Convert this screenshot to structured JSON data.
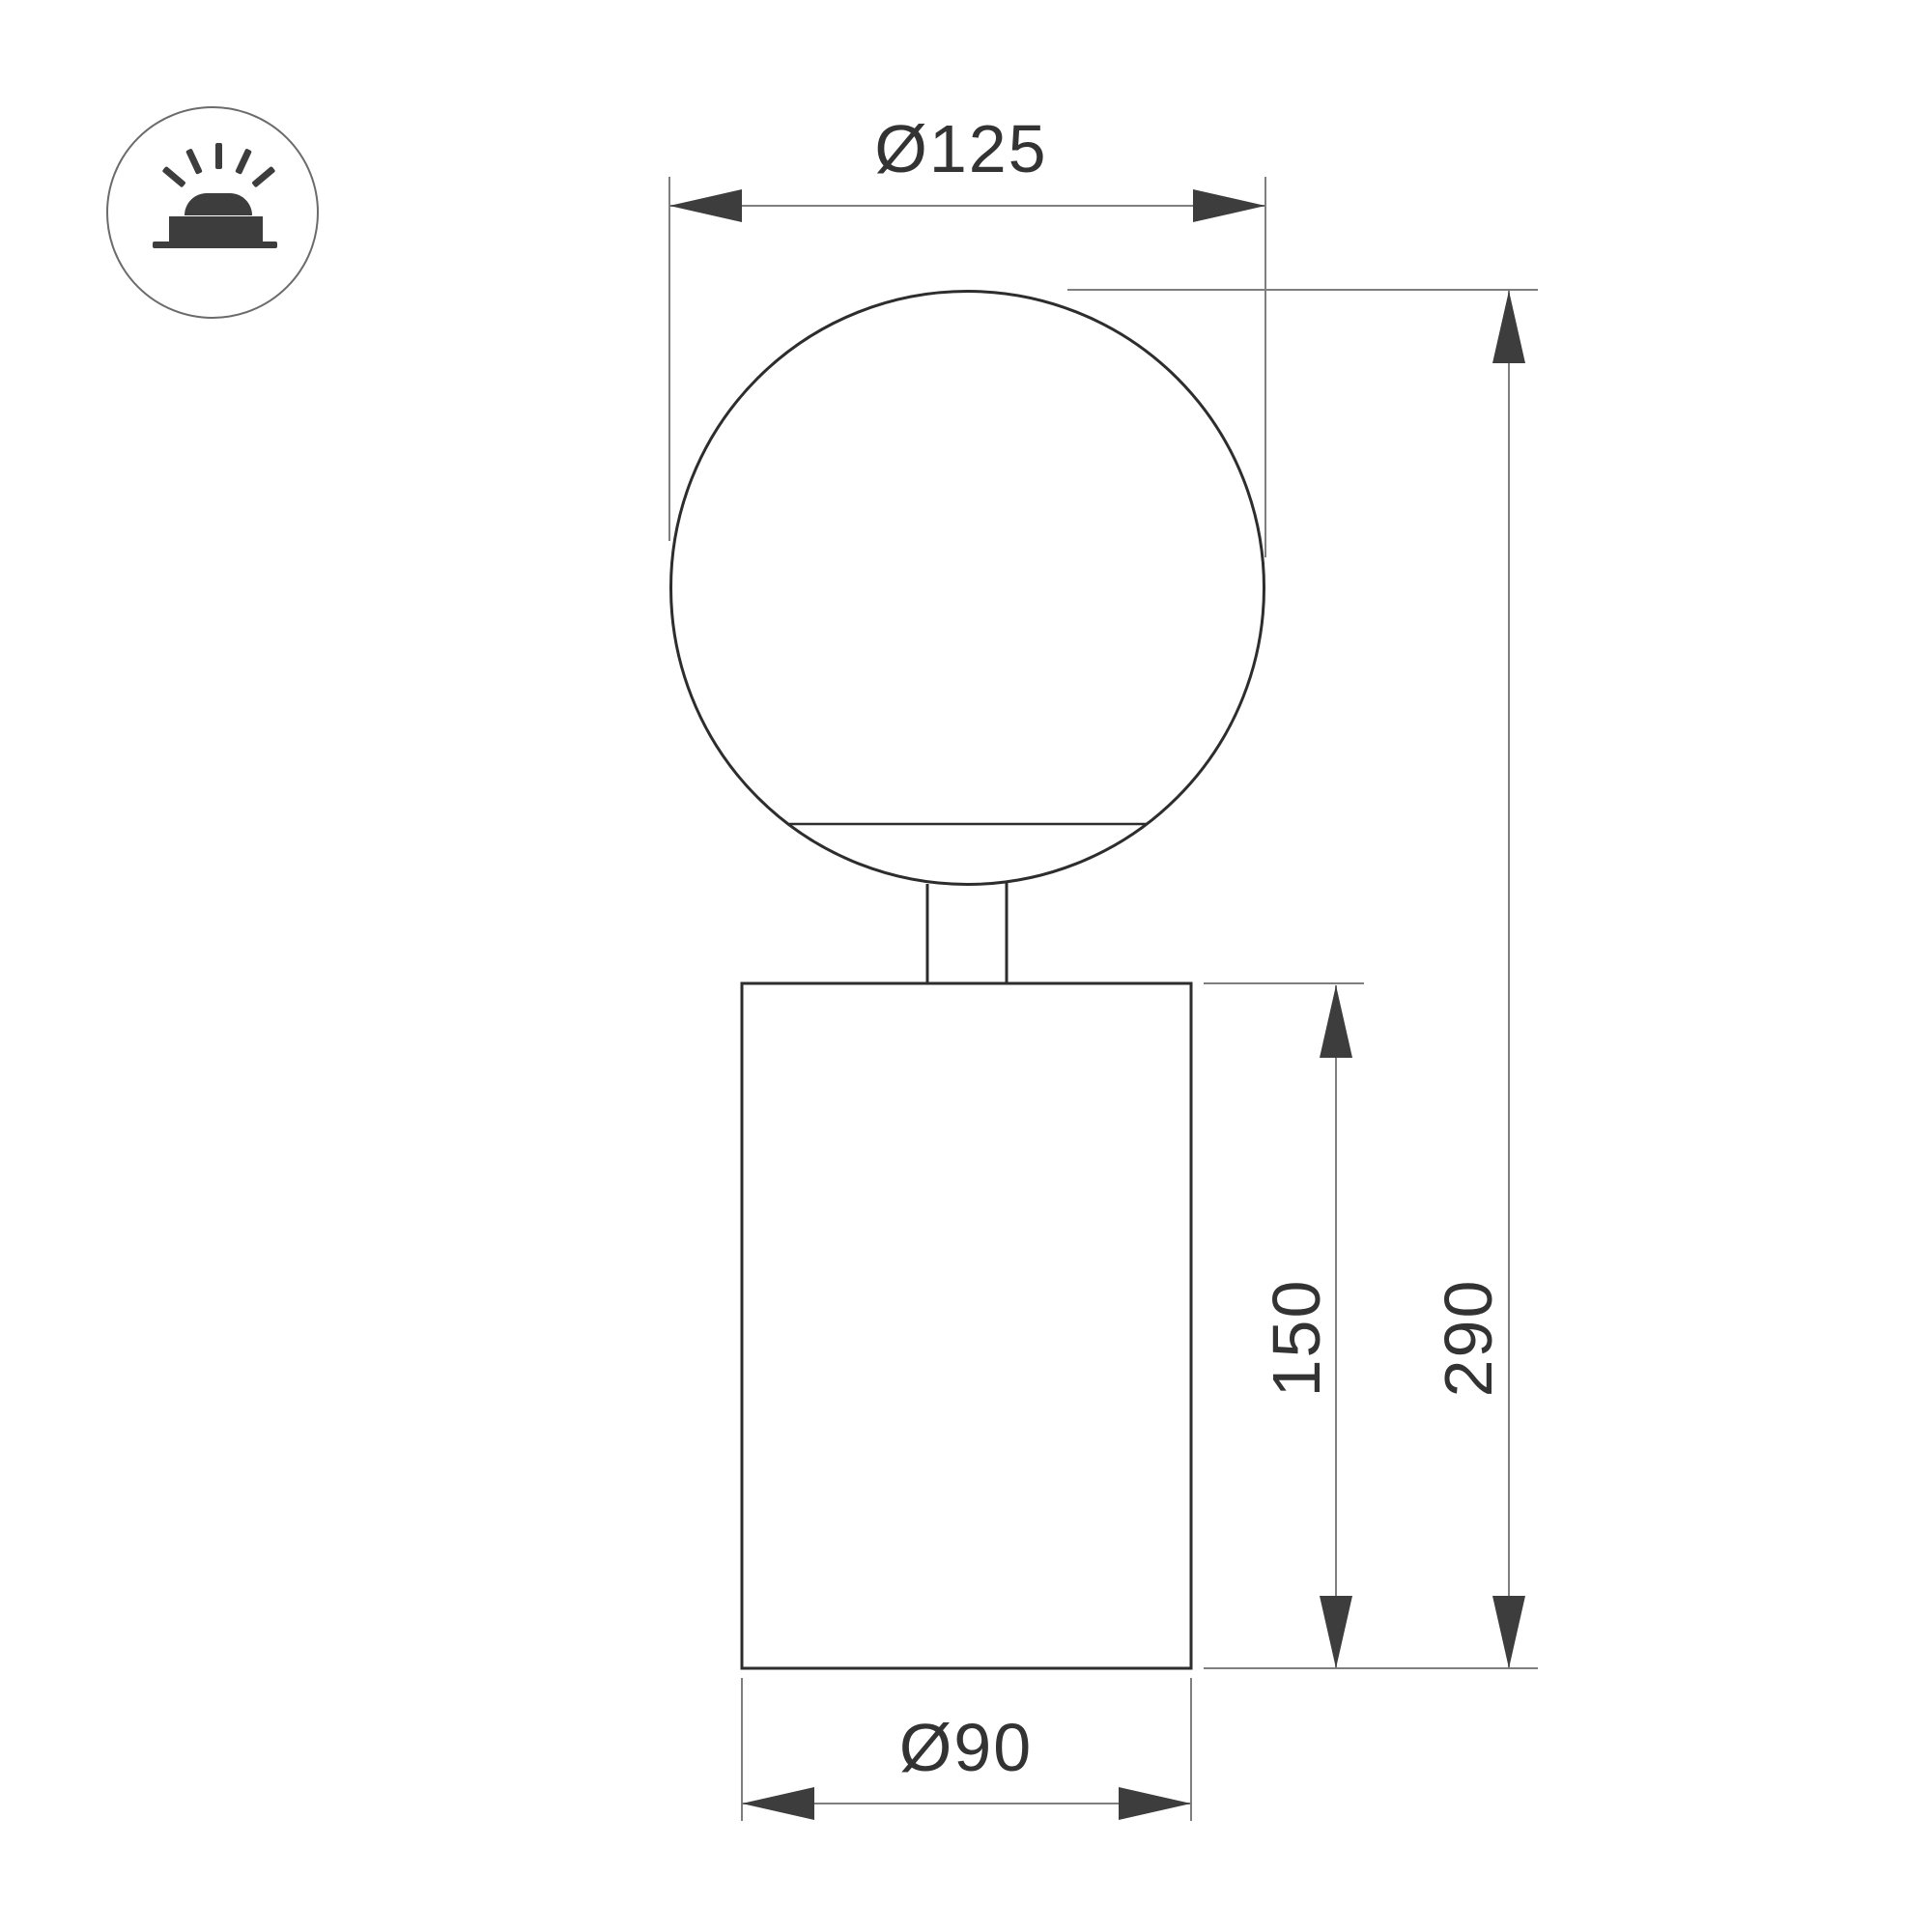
{
  "icon": {
    "name": "surface-mounted-light",
    "description": "luminaire on surface with light rays"
  },
  "dimensions": {
    "globe_diameter": "Ø125",
    "total_height": "290",
    "body_height": "150",
    "body_diameter": "Ø90"
  },
  "colors": {
    "background": "#ffffff",
    "object_line": "#2d2d2d",
    "dimension_line": "#7f7f7f",
    "arrow": "#3d3d3d",
    "text": "#333333",
    "icon": "#3d3d3d",
    "icon_ring": "#6b6b6b"
  }
}
